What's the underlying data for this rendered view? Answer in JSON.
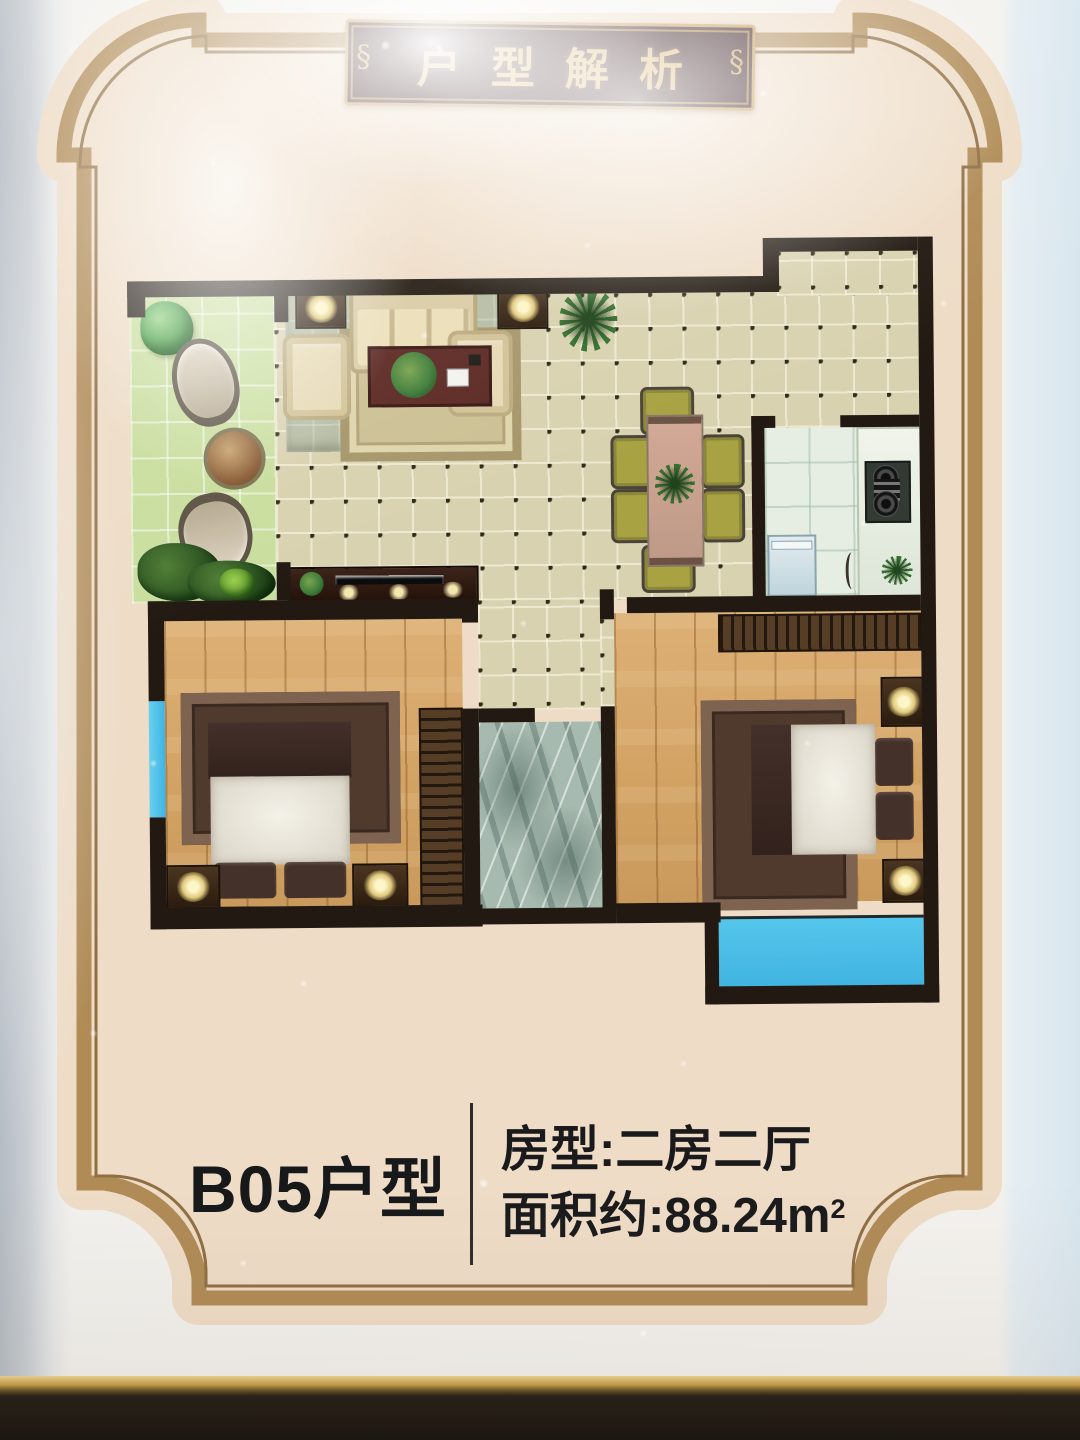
{
  "banner": {
    "title": "户型解析"
  },
  "footer": {
    "unit": "B05户型",
    "room_type": "房型:二房二厅",
    "area": "面积约:88.24m",
    "area_sup": "2"
  },
  "palette": {
    "poster_cream": "#eedcc6",
    "frame_gold": "#b08b56",
    "banner_bg": "#2d1014",
    "banner_gold": "#d9ae62",
    "wall_black": "#221a12",
    "balcony_green": "#c9de9e",
    "floor_tile": "#d9d2b0",
    "wood_floor": "#d7a76a",
    "bath_marble": "#a7bab0",
    "window_blue": "#4fc0e6",
    "kitchen_tile": "#e6eee3",
    "text_black": "#17181a"
  }
}
